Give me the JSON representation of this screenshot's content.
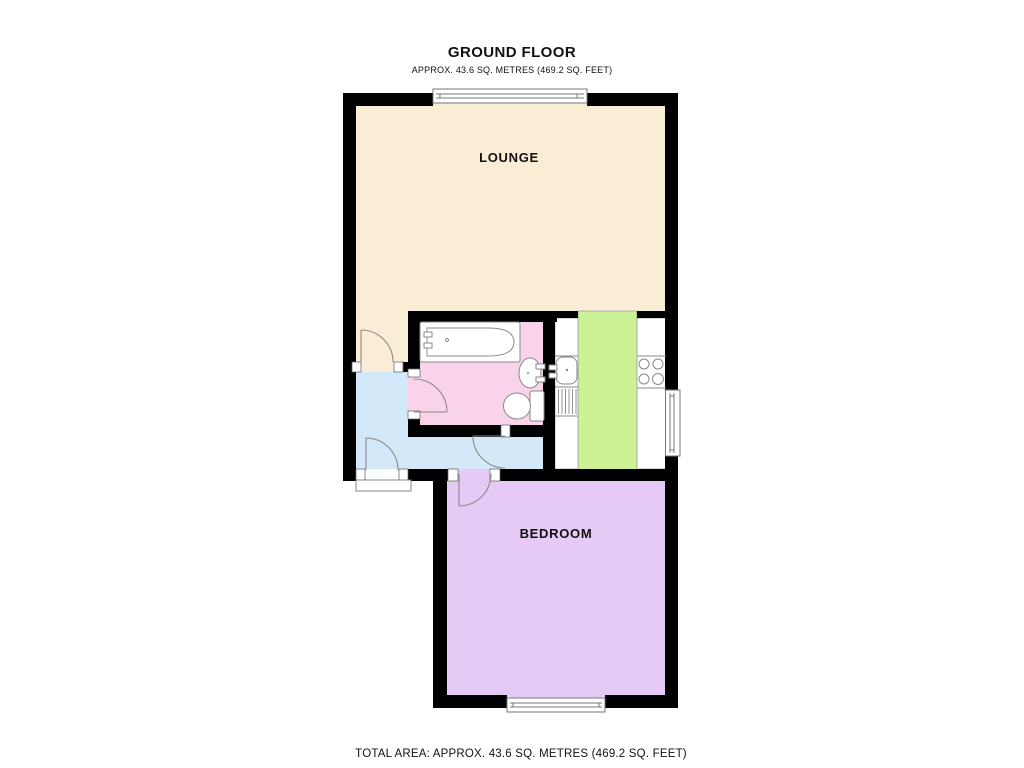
{
  "header": {
    "title": "GROUND FLOOR",
    "subtitle": "APPROX.  43.6 SQ. METRES (469.2 SQ. FEET)"
  },
  "footer": {
    "total_area": "TOTAL AREA: APPROX.  43.6 SQ. METRES (469.2 SQ. FEET)"
  },
  "rooms": {
    "lounge": {
      "label": "LOUNGE",
      "floor_color": "#FAEDD5"
    },
    "bathroom": {
      "floor_color": "#F8D3E9"
    },
    "hallway": {
      "floor_color": "#D3E8F8"
    },
    "kitchen": {
      "floor_color": "#CDF195",
      "counter_color": "#FFFFFF"
    },
    "bedroom": {
      "label": "BEDROOM",
      "floor_color": "#E4CAF4"
    }
  },
  "plan": {
    "wall_color": "#000000",
    "jamb_color": "#FFFFFF",
    "door_arc_color": "#8A8A8A",
    "window_frame_color": "#777777",
    "fixture_stroke_color": "#888888",
    "fixture_dot_color": "#888888",
    "label_color": "#111111"
  }
}
